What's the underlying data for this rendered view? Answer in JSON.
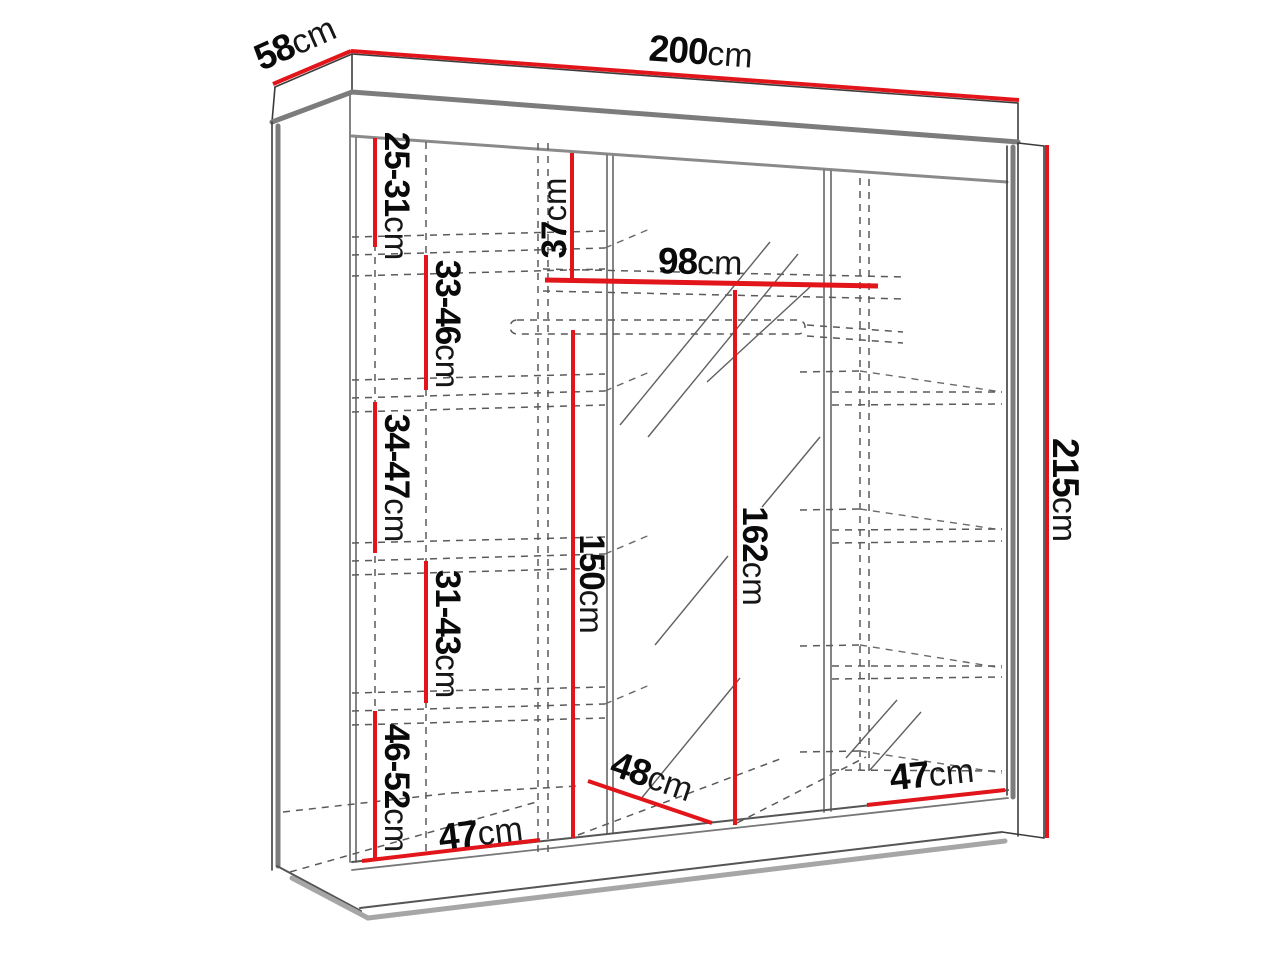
{
  "diagram": {
    "type": "wardrobe-dimension-drawing",
    "unit": "cm",
    "accent_color": "#e2151b",
    "line_color": "#3c3c3c",
    "dimensions": {
      "depth_top": {
        "num": "58",
        "unit": "cm"
      },
      "width_top": {
        "num": "200",
        "unit": "cm"
      },
      "height_right": {
        "num": "215",
        "unit": "cm"
      },
      "shelf_gap_1": {
        "num": "25-31",
        "unit": "cm"
      },
      "shelf_gap_2": {
        "num": "33-46",
        "unit": "cm"
      },
      "shelf_gap_3": {
        "num": "34-47",
        "unit": "cm"
      },
      "shelf_gap_4": {
        "num": "31-43",
        "unit": "cm"
      },
      "shelf_gap_5": {
        "num": "46-52",
        "unit": "cm"
      },
      "top_clearance": {
        "num": "37",
        "unit": "cm"
      },
      "middle_width": {
        "num": "98",
        "unit": "cm"
      },
      "hanging_height": {
        "num": "150",
        "unit": "cm"
      },
      "mirror_height": {
        "num": "162",
        "unit": "cm"
      },
      "middle_depth": {
        "num": "48",
        "unit": "cm"
      },
      "left_bottom": {
        "num": "47",
        "unit": "cm"
      },
      "right_bottom": {
        "num": "47",
        "unit": "cm"
      }
    }
  }
}
